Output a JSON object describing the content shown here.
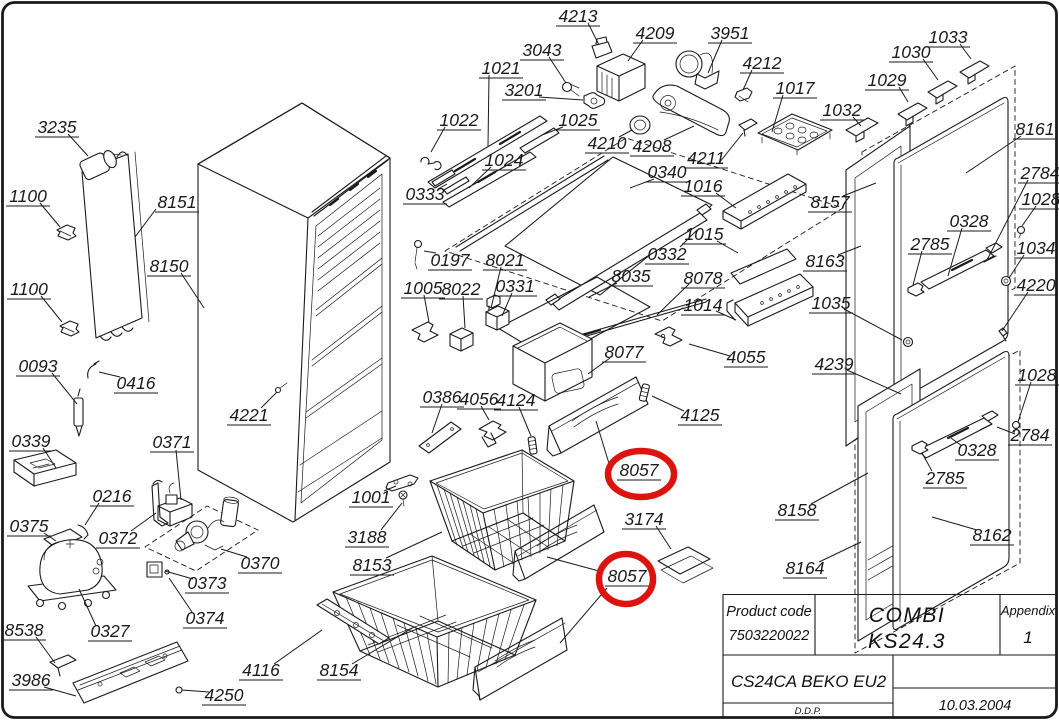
{
  "document": {
    "type": "exploded-parts-diagram",
    "product": "COMBI KS24.3",
    "variant": "CS24CA BEKO EU2"
  },
  "colors": {
    "line": "#1a1a1a",
    "highlight": "#dd1310",
    "background": "#ffffff"
  },
  "title_block": {
    "product_code_label": "Product code",
    "product_code_value": "7503220022",
    "model_line1": "COMBI",
    "model_line2": "KS24.3",
    "appendix_label": "Appendix",
    "appendix_value": "1",
    "variant": "CS24CA BEKO EU2",
    "drafter": "D.D.P.",
    "date": "10.03.2004"
  },
  "highlights": [
    {
      "part": "8057",
      "cx": 641,
      "cy": 474,
      "rx": 33,
      "ry": 23
    },
    {
      "part": "8057",
      "cx": 626,
      "cy": 579,
      "rx": 27,
      "ry": 25
    }
  ],
  "labels": [
    {
      "t": "3235",
      "x": 57,
      "y": 127,
      "lead": [
        [
          68,
          134
        ],
        [
          88,
          156
        ]
      ]
    },
    {
      "t": "1100",
      "x": 28,
      "y": 196,
      "lead": [
        [
          40,
          203
        ],
        [
          60,
          227
        ]
      ]
    },
    {
      "t": "8151",
      "x": 177,
      "y": 202,
      "lead": [
        [
          156,
          209
        ],
        [
          135,
          237
        ]
      ]
    },
    {
      "t": "8150",
      "x": 169,
      "y": 266,
      "lead": [
        [
          181,
          273
        ],
        [
          204,
          308
        ]
      ]
    },
    {
      "t": "1100",
      "x": 29,
      "y": 289,
      "lead": [
        [
          41,
          296
        ],
        [
          62,
          322
        ]
      ]
    },
    {
      "t": "0093",
      "x": 38,
      "y": 366,
      "lead": [
        [
          52,
          373
        ],
        [
          77,
          404
        ]
      ]
    },
    {
      "t": "0416",
      "x": 136,
      "y": 383,
      "lead": [
        [
          120,
          377
        ],
        [
          99,
          372
        ]
      ]
    },
    {
      "t": "4221",
      "x": 249,
      "y": 415,
      "lead": [
        [
          261,
          408
        ],
        [
          277,
          392
        ]
      ]
    },
    {
      "t": "0339",
      "x": 31,
      "y": 441,
      "lead": [
        [
          43,
          448
        ],
        [
          56,
          468
        ]
      ]
    },
    {
      "t": "0371",
      "x": 172,
      "y": 442,
      "lead": [
        [
          176,
          450
        ],
        [
          181,
          500
        ]
      ]
    },
    {
      "t": "0216",
      "x": 112,
      "y": 496,
      "lead": [
        [
          99,
          503
        ],
        [
          85,
          525
        ]
      ]
    },
    {
      "t": "0375",
      "x": 29,
      "y": 526,
      "lead": [
        [
          44,
          533
        ],
        [
          56,
          541
        ]
      ]
    },
    {
      "t": "0372",
      "x": 118,
      "y": 538,
      "lead": [
        [
          131,
          531
        ],
        [
          156,
          513
        ]
      ]
    },
    {
      "t": "0370",
      "x": 260,
      "y": 563,
      "lead": [
        [
          247,
          557
        ],
        [
          221,
          549
        ]
      ]
    },
    {
      "t": "0373",
      "x": 207,
      "y": 583,
      "lead": [
        [
          193,
          579
        ],
        [
          165,
          571
        ]
      ]
    },
    {
      "t": "0374",
      "x": 205,
      "y": 618,
      "lead": [
        [
          192,
          612
        ],
        [
          169,
          578
        ]
      ]
    },
    {
      "t": "0327",
      "x": 110,
      "y": 631,
      "lead": [
        [
          96,
          626
        ],
        [
          79,
          589
        ]
      ]
    },
    {
      "t": "8538",
      "x": 24,
      "y": 630,
      "lead": [
        [
          36,
          637
        ],
        [
          55,
          663
        ]
      ]
    },
    {
      "t": "3986",
      "x": 31,
      "y": 680,
      "lead": [
        [
          44,
          687
        ],
        [
          76,
          696
        ]
      ]
    },
    {
      "t": "4116",
      "x": 261,
      "y": 670,
      "lead": [
        [
          274,
          664
        ],
        [
          322,
          630
        ]
      ]
    },
    {
      "t": "8154",
      "x": 339,
      "y": 670,
      "lead": [
        [
          352,
          664
        ],
        [
          414,
          627
        ]
      ]
    },
    {
      "t": "4250",
      "x": 224,
      "y": 695,
      "lead": [
        [
          209,
          692
        ],
        [
          182,
          690
        ]
      ]
    },
    {
      "t": "1001",
      "x": 371,
      "y": 497,
      "lead": [
        [
          384,
          491
        ],
        [
          396,
          486
        ]
      ]
    },
    {
      "t": "3188",
      "x": 367,
      "y": 537,
      "lead": [
        [
          381,
          530
        ],
        [
          402,
          503
        ]
      ]
    },
    {
      "t": "8153",
      "x": 372,
      "y": 565,
      "lead": [
        [
          386,
          558
        ],
        [
          442,
          532
        ]
      ]
    },
    {
      "t": "0197",
      "x": 450,
      "y": 260,
      "lead": [
        [
          436,
          253
        ],
        [
          424,
          251
        ]
      ]
    },
    {
      "t": "1005",
      "x": 423,
      "y": 288,
      "lead": [
        [
          424,
          295
        ],
        [
          429,
          322
        ]
      ]
    },
    {
      "t": "8022",
      "x": 461,
      "y": 289,
      "lead": [
        [
          463,
          296
        ],
        [
          465,
          328
        ]
      ]
    },
    {
      "t": "8021",
      "x": 505,
      "y": 260,
      "lead": [
        [
          501,
          267
        ],
        [
          491,
          308
        ]
      ]
    },
    {
      "t": "0331",
      "x": 515,
      "y": 286,
      "lead": [
        [
          512,
          293
        ],
        [
          502,
          316
        ]
      ]
    },
    {
      "t": "0333",
      "x": 425,
      "y": 194,
      "lead": [
        [
          438,
          189
        ],
        [
          447,
          184
        ]
      ]
    },
    {
      "t": "1022",
      "x": 459,
      "y": 120,
      "lead": [
        [
          445,
          127
        ],
        [
          431,
          152
        ]
      ]
    },
    {
      "t": "1021",
      "x": 501,
      "y": 68,
      "lead": [
        [
          489,
          75
        ],
        [
          488,
          146
        ]
      ]
    },
    {
      "t": "3201",
      "x": 524,
      "y": 90,
      "lead": [
        [
          539,
          97
        ],
        [
          583,
          100
        ]
      ]
    },
    {
      "t": "3043",
      "x": 542,
      "y": 50,
      "lead": [
        [
          549,
          57
        ],
        [
          566,
          83
        ]
      ]
    },
    {
      "t": "4213",
      "x": 578,
      "y": 16,
      "lead": [
        [
          588,
          23
        ],
        [
          599,
          45
        ]
      ]
    },
    {
      "t": "4209",
      "x": 655,
      "y": 33,
      "lead": [
        [
          643,
          40
        ],
        [
          628,
          61
        ]
      ]
    },
    {
      "t": "3951",
      "x": 730,
      "y": 33,
      "lead": [
        [
          722,
          40
        ],
        [
          708,
          73
        ]
      ]
    },
    {
      "t": "4212",
      "x": 762,
      "y": 63,
      "lead": [
        [
          752,
          70
        ],
        [
          743,
          90
        ]
      ]
    },
    {
      "t": "1017",
      "x": 795,
      "y": 88,
      "lead": [
        [
          783,
          95
        ],
        [
          772,
          132
        ]
      ]
    },
    {
      "t": "1025",
      "x": 578,
      "y": 120,
      "lead": [
        [
          563,
          127
        ],
        [
          542,
          135
        ]
      ]
    },
    {
      "t": "1024",
      "x": 504,
      "y": 160,
      "lead": [
        [
          491,
          167
        ],
        [
          469,
          188
        ]
      ]
    },
    {
      "t": "4210",
      "x": 607,
      "y": 143,
      "lead": [
        [
          619,
          137
        ],
        [
          632,
          130
        ]
      ]
    },
    {
      "t": "4208",
      "x": 652,
      "y": 146,
      "lead": [
        [
          664,
          140
        ],
        [
          694,
          126
        ]
      ]
    },
    {
      "t": "4211",
      "x": 706,
      "y": 158,
      "lead": [
        [
          719,
          163
        ],
        [
          743,
          133
        ]
      ]
    },
    {
      "t": "0340",
      "x": 667,
      "y": 172,
      "lead": [
        [
          654,
          179
        ],
        [
          630,
          188
        ]
      ]
    },
    {
      "t": "1016",
      "x": 703,
      "y": 186,
      "lead": [
        [
          716,
          193
        ],
        [
          736,
          208
        ]
      ]
    },
    {
      "t": "0332",
      "x": 667,
      "y": 254,
      "lead": [
        [
          680,
          247
        ],
        [
          697,
          230
        ]
      ]
    },
    {
      "t": "1015",
      "x": 704,
      "y": 234,
      "lead": [
        [
          717,
          241
        ],
        [
          738,
          253
        ]
      ]
    },
    {
      "t": "8035",
      "x": 631,
      "y": 276,
      "lead": [
        [
          617,
          283
        ],
        [
          589,
          297
        ]
      ]
    },
    {
      "t": "8078",
      "x": 703,
      "y": 278,
      "lead": [
        [
          689,
          284
        ],
        [
          657,
          315
        ]
      ]
    },
    {
      "t": "1014",
      "x": 703,
      "y": 305,
      "lead": [
        [
          716,
          311
        ],
        [
          736,
          320
        ]
      ]
    },
    {
      "t": "4055",
      "x": 746,
      "y": 357,
      "lead": [
        [
          730,
          356
        ],
        [
          689,
          344
        ]
      ]
    },
    {
      "t": "8077",
      "x": 624,
      "y": 352,
      "lead": [
        [
          610,
          358
        ],
        [
          588,
          374
        ]
      ]
    },
    {
      "t": "0386",
      "x": 442,
      "y": 397,
      "lead": [
        [
          442,
          404
        ],
        [
          432,
          433
        ]
      ]
    },
    {
      "t": "4056",
      "x": 479,
      "y": 399,
      "lead": [
        [
          481,
          406
        ],
        [
          489,
          420
        ]
      ]
    },
    {
      "t": "4124",
      "x": 516,
      "y": 400,
      "lead": [
        [
          519,
          407
        ],
        [
          531,
          436
        ]
      ]
    },
    {
      "t": "4125",
      "x": 700,
      "y": 415,
      "lead": [
        [
          684,
          411
        ],
        [
          652,
          396
        ]
      ]
    },
    {
      "t": "8057",
      "x": 639,
      "y": 470,
      "lead": [
        [
          611,
          470
        ],
        [
          596,
          421
        ]
      ]
    },
    {
      "t": "3174",
      "x": 644,
      "y": 519,
      "lead": [
        [
          656,
          526
        ],
        [
          671,
          549
        ]
      ]
    },
    {
      "t": "8057",
      "x": 627,
      "y": 576,
      "lead": [
        [
          607,
          588
        ],
        [
          560,
          643
        ]
      ],
      "lead2": [
        [
          599,
          571
        ],
        [
          547,
          557
        ]
      ]
    },
    {
      "t": "1030",
      "x": 911,
      "y": 52,
      "lead": [
        [
          923,
          59
        ],
        [
          938,
          80
        ]
      ]
    },
    {
      "t": "1033",
      "x": 948,
      "y": 37,
      "lead": [
        [
          960,
          44
        ],
        [
          971,
          59
        ]
      ]
    },
    {
      "t": "1029",
      "x": 887,
      "y": 80,
      "lead": [
        [
          899,
          87
        ],
        [
          908,
          102
        ]
      ]
    },
    {
      "t": "1032",
      "x": 842,
      "y": 110,
      "lead": [
        [
          853,
          117
        ],
        [
          861,
          126
        ]
      ]
    },
    {
      "t": "8161",
      "x": 1035,
      "y": 129,
      "lead": [
        [
          1021,
          136
        ],
        [
          966,
          173
        ]
      ]
    },
    {
      "t": "2784",
      "x": 1040,
      "y": 173,
      "lead": [
        [
          1028,
          180
        ],
        [
          987,
          260
        ]
      ]
    },
    {
      "t": "1028",
      "x": 1041,
      "y": 199,
      "lead": [
        [
          1036,
          206
        ],
        [
          1022,
          226
        ]
      ]
    },
    {
      "t": "0328",
      "x": 969,
      "y": 221,
      "lead": [
        [
          962,
          228
        ],
        [
          948,
          276
        ]
      ]
    },
    {
      "t": "2785",
      "x": 930,
      "y": 244,
      "lead": [
        [
          922,
          251
        ],
        [
          913,
          285
        ]
      ]
    },
    {
      "t": "8157",
      "x": 830,
      "y": 202,
      "lead": [
        [
          843,
          196
        ],
        [
          876,
          183
        ]
      ]
    },
    {
      "t": "1034",
      "x": 1036,
      "y": 248,
      "lead": [
        [
          1024,
          255
        ],
        [
          1009,
          278
        ]
      ]
    },
    {
      "t": "8163",
      "x": 825,
      "y": 261,
      "lead": [
        [
          838,
          255
        ],
        [
          861,
          246
        ]
      ]
    },
    {
      "t": "4220",
      "x": 1036,
      "y": 285,
      "lead": [
        [
          1028,
          292
        ],
        [
          1002,
          331
        ]
      ]
    },
    {
      "t": "1035",
      "x": 831,
      "y": 303,
      "lead": [
        [
          844,
          309
        ],
        [
          902,
          340
        ]
      ]
    },
    {
      "t": "4239",
      "x": 834,
      "y": 364,
      "lead": [
        [
          847,
          370
        ],
        [
          901,
          394
        ]
      ]
    },
    {
      "t": "1028",
      "x": 1037,
      "y": 375,
      "lead": [
        [
          1031,
          382
        ],
        [
          1018,
          422
        ]
      ]
    },
    {
      "t": "2784",
      "x": 1030,
      "y": 435,
      "lead": [
        [
          1015,
          434
        ],
        [
          997,
          427
        ]
      ]
    },
    {
      "t": "0328",
      "x": 977,
      "y": 450,
      "lead": [
        [
          962,
          446
        ],
        [
          951,
          438
        ]
      ]
    },
    {
      "t": "2785",
      "x": 945,
      "y": 478,
      "lead": [
        [
          932,
          471
        ],
        [
          922,
          453
        ]
      ]
    },
    {
      "t": "8158",
      "x": 797,
      "y": 510,
      "lead": [
        [
          811,
          504
        ],
        [
          868,
          473
        ]
      ]
    },
    {
      "t": "8162",
      "x": 992,
      "y": 535,
      "lead": [
        [
          977,
          530
        ],
        [
          932,
          517
        ]
      ]
    },
    {
      "t": "8164",
      "x": 805,
      "y": 568,
      "lead": [
        [
          819,
          562
        ],
        [
          861,
          542
        ]
      ]
    }
  ]
}
